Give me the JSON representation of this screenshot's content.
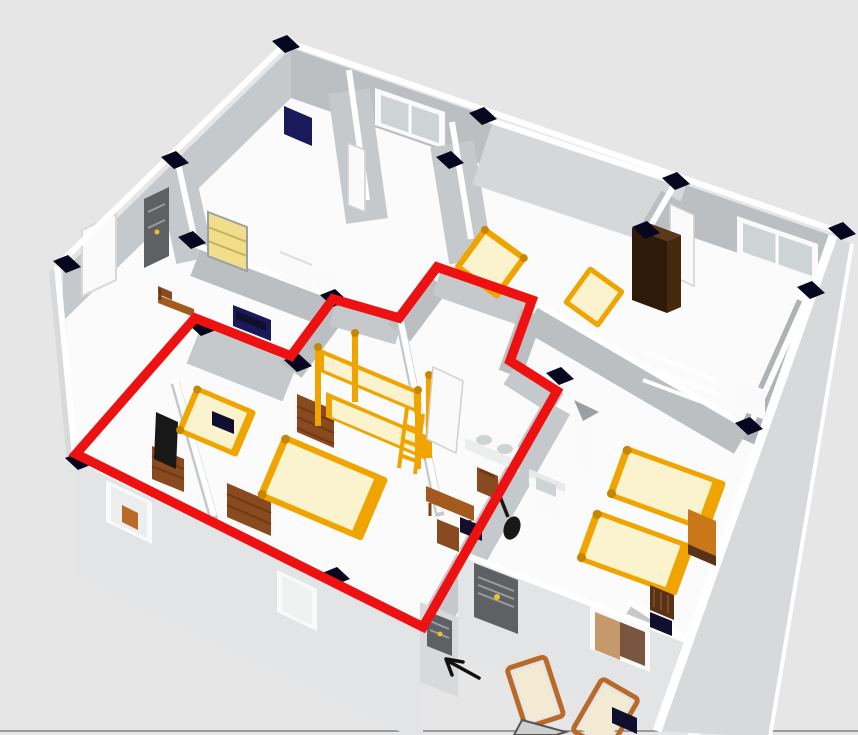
{
  "view": {
    "type": "3d-floorplan-render",
    "zoom_level": "overview"
  },
  "colors": {
    "bg": "#e6e6e7",
    "bottom_line": "#9a9a9a",
    "wall_top": "#ffffff",
    "wall_face_light": "#c6c9cc",
    "wall_face_mid": "#bbbfc2",
    "wall_face_dark": "#afb3b7",
    "wall_face_lit": "#d5d7d9",
    "ext_face": "#e3e4e6",
    "ext_face_side": "#d7d9db",
    "floor": "#fbfbfb",
    "cap": "#06061e",
    "red": "#ee1111",
    "arrow": "#111111",
    "bed_frame": "#f0a400",
    "bed_frame_dark": "#c88600",
    "mattress": "#fbf3cd",
    "dresser": "#8a4a1f",
    "dresser_dark": "#6e3a16",
    "wardrobe": "#2e1a08",
    "wardrobe_side": "#46280e",
    "wardrobe_top": "#5a3a18",
    "nightstand": "#c87818",
    "table": "#a25a1e",
    "chair_wood": "#8a4a1f",
    "sofa": "#1a1a5a",
    "dark_navy": "#10102e",
    "tv": "#181818",
    "bookshelf": "#f2de8a",
    "shelf_line": "#c8b060",
    "white_obj": "#fafafa",
    "door_dark": "#5e6063",
    "door_stripe": "#9a9da0",
    "knob": "#f0c020",
    "glass": "#ced3d4",
    "lounge_wood": "#b96a28",
    "cushion": "#f2ead2",
    "window_int_tan": "#c49a6c",
    "window_int_brown": "#7a5540"
  },
  "annotation": {
    "red_outline_points": "195,318 291,356 333,299 399,318 437,267 532,300 510,361 557,391 423,627 76,454",
    "arrow_path": "M479,678 L448,661 M463,662 L446,659 L452,675"
  },
  "objects": [
    "bunk-bed",
    "double-bed",
    "single-bed",
    "tv-on-dresser",
    "dresser",
    "bookshelf",
    "fridge",
    "navy-armchair",
    "navy-sofa",
    "dining-table",
    "kitchen-sink",
    "bathroom-vanity",
    "guitar",
    "wardrobe",
    "nightstand",
    "entrance-door",
    "lounge-chairs",
    "windows"
  ]
}
